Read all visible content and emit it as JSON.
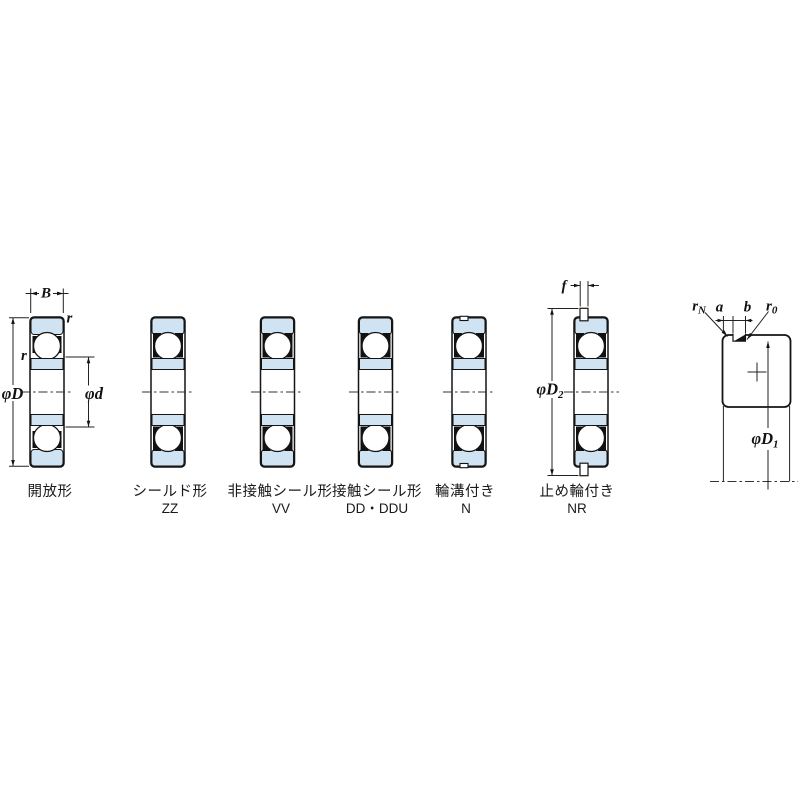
{
  "diagram": {
    "bearings": [
      {
        "label": "開放形",
        "code": ""
      },
      {
        "label": "シールド形",
        "code": "ZZ"
      },
      {
        "label": "非接触シール形",
        "code": "VV"
      },
      {
        "label": "接触シール形",
        "code": "DD・DDU"
      },
      {
        "label": "輪溝付き",
        "code": "N"
      },
      {
        "label": "止め輪付き",
        "code": "NR"
      }
    ],
    "dims": {
      "B": "B",
      "r_top": "r",
      "r_side": "r",
      "phiD": "φD",
      "phid": "φd",
      "f": "f",
      "phiD2": {
        "base": "φD",
        "sub": "2"
      },
      "phiD1": {
        "base": "φD",
        "sub": "1"
      },
      "a": "a",
      "b": "b",
      "rN": {
        "base": "r",
        "sub": "N"
      },
      "r0": {
        "base": "r",
        "sub": "0"
      }
    },
    "colors": {
      "ring_fill": "#cfe3f2",
      "line": "#1a1a1a"
    }
  }
}
